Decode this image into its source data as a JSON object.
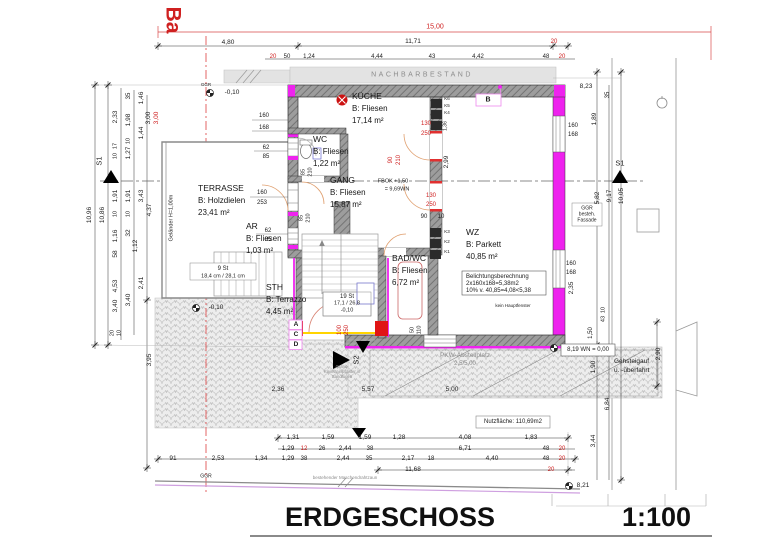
{
  "meta": {
    "title": "ERDGESCHOSS",
    "scale": "1:100"
  },
  "rooms": [
    {
      "name": "KÜCHE",
      "finish": "B: Fliesen",
      "area": "17,14 m²",
      "x": 352,
      "y": 90
    },
    {
      "name": "WC",
      "finish": "B: Fliesen",
      "area": "1,22 m²",
      "x": 313,
      "y": 133
    },
    {
      "name": "GANG",
      "finish": "B: Fliesen",
      "area": "15,87 m²",
      "x": 330,
      "y": 174
    },
    {
      "name": "TERRASSE",
      "finish": "B: Holzdielen",
      "area": "23,41 m²",
      "x": 198,
      "y": 182
    },
    {
      "name": "AR",
      "finish": "B: Fliesen",
      "area": "1,03 m²",
      "x": 246,
      "y": 220
    },
    {
      "name": "WZ",
      "finish": "B: Parkett",
      "area": "40,85 m²",
      "x": 466,
      "y": 226
    },
    {
      "name": "BAD/WC",
      "finish": "B: Fliesen",
      "area": "6,72 m²",
      "x": 392,
      "y": 252
    },
    {
      "name": "STH",
      "finish": "B: Terrazzo",
      "area": "4,45 m²",
      "x": 266,
      "y": 281
    }
  ],
  "labels": [
    {
      "t": "Ba",
      "x": 173,
      "y": 20,
      "r": 2,
      "s": 21,
      "b": 1,
      "c": "r",
      "n": "bau-line-label"
    },
    {
      "t": "15,00",
      "x": 435,
      "y": 27,
      "c": "r",
      "s": 7
    },
    {
      "t": "4,80",
      "x": 228,
      "y": 43
    },
    {
      "t": "11,71",
      "x": 413,
      "y": 42
    },
    {
      "t": "20",
      "x": 554,
      "y": 42,
      "c": "r",
      "s": 6
    },
    {
      "t": "20",
      "x": 273,
      "y": 57,
      "c": "r",
      "s": 6
    },
    {
      "t": "50",
      "x": 287,
      "y": 57,
      "s": 6
    },
    {
      "t": "1,24",
      "x": 309,
      "y": 57,
      "s": 6
    },
    {
      "t": "4,44",
      "x": 377,
      "y": 57,
      "s": 6
    },
    {
      "t": "43",
      "x": 432,
      "y": 57,
      "s": 6
    },
    {
      "t": "4,42",
      "x": 478,
      "y": 57,
      "s": 6
    },
    {
      "t": "48",
      "x": 546,
      "y": 57,
      "s": 6
    },
    {
      "t": "20",
      "x": 562,
      "y": 57,
      "c": "r",
      "s": 6
    },
    {
      "t": "NACHBARBESTAND",
      "x": 422,
      "y": 75,
      "c": "g",
      "k": 1,
      "s": 7,
      "n": "neighbor-building-label"
    },
    {
      "t": "8,23",
      "x": 586,
      "y": 87
    },
    {
      "t": "GGR",
      "x": 206,
      "y": 85,
      "s": 4.5,
      "n": "ggr-label"
    },
    {
      "t": "-0,10",
      "x": 232,
      "y": 93,
      "s": 6.5,
      "n": "level-label"
    },
    {
      "t": "10,96",
      "x": 90,
      "y": 215,
      "r": 1
    },
    {
      "t": "10,86",
      "x": 103,
      "y": 215,
      "r": 1
    },
    {
      "t": "2,33",
      "x": 116,
      "y": 117,
      "r": 1
    },
    {
      "t": "17",
      "x": 116,
      "y": 146,
      "r": 1,
      "s": 5.5
    },
    {
      "t": "10",
      "x": 116,
      "y": 156,
      "r": 1,
      "s": 5.5
    },
    {
      "t": "1,91",
      "x": 116,
      "y": 196,
      "r": 1
    },
    {
      "t": "10",
      "x": 116,
      "y": 214,
      "r": 1,
      "s": 5.5
    },
    {
      "t": "1,16",
      "x": 116,
      "y": 236,
      "r": 1
    },
    {
      "t": "58",
      "x": 116,
      "y": 254,
      "r": 1
    },
    {
      "t": "4,53",
      "x": 116,
      "y": 286,
      "r": 1
    },
    {
      "t": "3,40",
      "x": 116,
      "y": 306,
      "r": 1
    },
    {
      "t": "20",
      "x": 113,
      "y": 333,
      "r": 1,
      "s": 5.5
    },
    {
      "t": "10",
      "x": 120,
      "y": 333,
      "r": 1,
      "s": 5.5
    },
    {
      "t": "35",
      "x": 129,
      "y": 96,
      "r": 1,
      "s": 6
    },
    {
      "t": "1,98",
      "x": 129,
      "y": 120,
      "r": 1
    },
    {
      "t": "10",
      "x": 129,
      "y": 141,
      "r": 1,
      "s": 5.5
    },
    {
      "t": "1,27",
      "x": 129,
      "y": 153,
      "r": 1
    },
    {
      "t": "1,91",
      "x": 129,
      "y": 196,
      "r": 1
    },
    {
      "t": "10",
      "x": 129,
      "y": 214,
      "r": 1,
      "s": 5.5
    },
    {
      "t": "32",
      "x": 129,
      "y": 233,
      "r": 1
    },
    {
      "t": "3,40",
      "x": 129,
      "y": 300,
      "r": 1
    },
    {
      "t": "1,46",
      "x": 142,
      "y": 98,
      "r": 1
    },
    {
      "t": "1,44",
      "x": 142,
      "y": 133,
      "r": 1
    },
    {
      "t": "3,43",
      "x": 142,
      "y": 196,
      "r": 1
    },
    {
      "t": "1,12",
      "x": 136,
      "y": 246,
      "r": 1
    },
    {
      "t": "2,41",
      "x": 142,
      "y": 283,
      "r": 1
    },
    {
      "t": "3,00",
      "x": 149,
      "y": 118,
      "r": 1
    },
    {
      "t": "3,00",
      "x": 157,
      "y": 118,
      "r": 1,
      "c": "r"
    },
    {
      "t": "4,37",
      "x": 150,
      "y": 210,
      "r": 1
    },
    {
      "t": "3,95",
      "x": 150,
      "y": 360,
      "r": 1
    },
    {
      "t": "S1",
      "x": 99,
      "y": 161,
      "r": 1,
      "s": 7.5,
      "n": "section-marker-label"
    },
    {
      "t": "160",
      "x": 264,
      "y": 116,
      "s": 6
    },
    {
      "t": "168",
      "x": 264,
      "y": 128,
      "s": 6
    },
    {
      "t": "62",
      "x": 266,
      "y": 148,
      "s": 6
    },
    {
      "t": "85",
      "x": 266,
      "y": 157,
      "s": 6
    },
    {
      "t": "160",
      "x": 262,
      "y": 193,
      "s": 6
    },
    {
      "t": "253",
      "x": 262,
      "y": 203,
      "s": 6
    },
    {
      "t": "62",
      "x": 268,
      "y": 231,
      "s": 6
    },
    {
      "t": "85",
      "x": 268,
      "y": 240,
      "s": 6
    },
    {
      "t": "85",
      "x": 304,
      "y": 172,
      "r": 1,
      "s": 5.5
    },
    {
      "t": "210",
      "x": 311,
      "y": 172,
      "r": 1,
      "s": 5.5
    },
    {
      "t": "85",
      "x": 302,
      "y": 218,
      "r": 1,
      "s": 5.5
    },
    {
      "t": "210",
      "x": 309,
      "y": 218,
      "r": 1,
      "s": 5.5
    },
    {
      "t": "Geländer H=1,00m",
      "x": 172,
      "y": 218,
      "r": 1,
      "s": 5.5,
      "n": "railing-label"
    },
    {
      "t": "9 St",
      "x": 223,
      "y": 269,
      "s": 6,
      "n": "stair-count-label"
    },
    {
      "t": "18,4 cm / 28,1 cm",
      "x": 223,
      "y": 277,
      "s": 5.5
    },
    {
      "t": "-0,10",
      "x": 216,
      "y": 308,
      "s": 6.5,
      "n": "level-label"
    },
    {
      "t": "19 St",
      "x": 347,
      "y": 297,
      "s": 6,
      "n": "stair-count-label"
    },
    {
      "t": "17,1 / 26,8",
      "x": 347,
      "y": 304,
      "s": 5.5
    },
    {
      "t": "-0,10",
      "x": 347,
      "y": 311,
      "s": 5.5
    },
    {
      "t": "FBOK +1,50",
      "x": 393,
      "y": 182,
      "s": 5.5,
      "n": "floor-level-label"
    },
    {
      "t": "= 9,69WN",
      "x": 397,
      "y": 190,
      "s": 5.5
    },
    {
      "t": "130",
      "x": 426,
      "y": 124,
      "c": "r",
      "s": 6
    },
    {
      "t": "250",
      "x": 426,
      "y": 134,
      "c": "r",
      "s": 6
    },
    {
      "t": "130",
      "x": 431,
      "y": 196,
      "c": "r",
      "s": 6
    },
    {
      "t": "250",
      "x": 431,
      "y": 205,
      "c": "r",
      "s": 6
    },
    {
      "t": "90",
      "x": 391,
      "y": 160,
      "r": 1,
      "c": "r",
      "s": 6
    },
    {
      "t": "210",
      "x": 399,
      "y": 160,
      "r": 1,
      "c": "r",
      "s": 6
    },
    {
      "t": "100",
      "x": 340,
      "y": 330,
      "r": 1,
      "c": "r",
      "s": 6
    },
    {
      "t": "250",
      "x": 347,
      "y": 330,
      "r": 1,
      "c": "r",
      "s": 6
    },
    {
      "t": "90",
      "x": 424,
      "y": 217,
      "s": 6
    },
    {
      "t": "10",
      "x": 441,
      "y": 217,
      "s": 6
    },
    {
      "t": "2,99",
      "x": 447,
      "y": 162,
      "r": 1
    },
    {
      "t": "K6",
      "x": 447,
      "y": 99,
      "s": 4.5
    },
    {
      "t": "K5",
      "x": 447,
      "y": 106,
      "s": 4.5
    },
    {
      "t": "K4",
      "x": 447,
      "y": 113,
      "s": 4.5
    },
    {
      "t": "1,36",
      "x": 446,
      "y": 126,
      "r": 1,
      "s": 5
    },
    {
      "t": "K3",
      "x": 447,
      "y": 232,
      "s": 4.5
    },
    {
      "t": "K2",
      "x": 447,
      "y": 242,
      "s": 4.5
    },
    {
      "t": "K1",
      "x": 447,
      "y": 252,
      "s": 4.5
    },
    {
      "t": "50",
      "x": 413,
      "y": 330,
      "r": 1,
      "s": 5.5
    },
    {
      "t": "110",
      "x": 420,
      "y": 330,
      "r": 1,
      "s": 5.5
    },
    {
      "t": "B",
      "x": 488,
      "y": 100,
      "s": 7,
      "b": 1,
      "n": "marker-b-label"
    },
    {
      "t": "Belichtungsberechnung",
      "x": 466,
      "y": 277,
      "s": 6,
      "a": "l",
      "n": "lighting-calc-line"
    },
    {
      "t": "2x160x168=5,38m2",
      "x": 466,
      "y": 284,
      "s": 6,
      "a": "l"
    },
    {
      "t": "10% v. 40,85=4,08<5,38",
      "x": 466,
      "y": 291,
      "s": 6,
      "a": "l"
    },
    {
      "t": "kein Hauptfenster",
      "x": 513,
      "y": 306,
      "s": 4.5
    },
    {
      "t": "35",
      "x": 608,
      "y": 95,
      "r": 1,
      "s": 6
    },
    {
      "t": "1,89",
      "x": 595,
      "y": 119,
      "r": 1
    },
    {
      "t": "160",
      "x": 573,
      "y": 126,
      "s": 6
    },
    {
      "t": "168",
      "x": 573,
      "y": 135,
      "s": 6
    },
    {
      "t": "S1",
      "x": 620,
      "y": 163,
      "s": 7.5,
      "n": "section-marker-label"
    },
    {
      "t": "5,82",
      "x": 598,
      "y": 198,
      "r": 1
    },
    {
      "t": "9,17",
      "x": 610,
      "y": 196,
      "r": 1
    },
    {
      "t": "10,05",
      "x": 622,
      "y": 196,
      "r": 1
    },
    {
      "t": "GGR",
      "x": 587,
      "y": 209,
      "s": 5
    },
    {
      "t": "besteh.",
      "x": 587,
      "y": 215,
      "s": 5
    },
    {
      "t": "Fassade",
      "x": 587,
      "y": 221,
      "s": 5
    },
    {
      "t": "160",
      "x": 571,
      "y": 264,
      "s": 6
    },
    {
      "t": "168",
      "x": 571,
      "y": 273,
      "s": 6
    },
    {
      "t": "2,35",
      "x": 572,
      "y": 288,
      "r": 1
    },
    {
      "t": "10",
      "x": 604,
      "y": 310,
      "r": 1,
      "s": 5.5
    },
    {
      "t": "43",
      "x": 604,
      "y": 319,
      "r": 1,
      "s": 5.5
    },
    {
      "t": "1,50",
      "x": 591,
      "y": 333,
      "r": 1,
      "s": 6
    },
    {
      "t": "8,19 WN = 0,00",
      "x": 588,
      "y": 350,
      "s": 6,
      "n": "datum-level-label"
    },
    {
      "t": "1,90",
      "x": 594,
      "y": 367,
      "r": 1
    },
    {
      "t": "Gehsteigauf",
      "x": 614,
      "y": 362,
      "s": 6.5,
      "a": "l",
      "n": "sidewalk-label"
    },
    {
      "t": "u. -überfahrt",
      "x": 614,
      "y": 371,
      "s": 6.5,
      "a": "l"
    },
    {
      "t": "2,90",
      "x": 659,
      "y": 354,
      "r": 1
    },
    {
      "t": "6,84",
      "x": 608,
      "y": 404,
      "r": 1
    },
    {
      "t": "3,44",
      "x": 594,
      "y": 441,
      "r": 1
    },
    {
      "t": "A",
      "x": 296,
      "y": 325,
      "s": 6.5,
      "b": 1,
      "n": "marker-a-label"
    },
    {
      "t": "C",
      "x": 296,
      "y": 335,
      "s": 6.5,
      "b": 1,
      "n": "marker-c-label"
    },
    {
      "t": "D",
      "x": 296,
      "y": 345,
      "s": 6.5,
      "b": 1,
      "n": "marker-d-label"
    },
    {
      "t": "S2",
      "x": 356,
      "y": 360,
      "r": 1,
      "s": 7.5,
      "n": "section-marker-label"
    },
    {
      "t": "Granit-",
      "x": 342,
      "y": 367,
      "s": 4.2,
      "c": "g"
    },
    {
      "t": "Kleinsteinpflaster in",
      "x": 342,
      "y": 372,
      "s": 4.2,
      "c": "g"
    },
    {
      "t": "Sandfugen",
      "x": 342,
      "y": 377,
      "s": 4.2,
      "c": "g"
    },
    {
      "t": "PKW-Abstellplatz",
      "x": 465,
      "y": 356,
      "s": 6.5,
      "c": "g",
      "n": "parking-label"
    },
    {
      "t": "2,5/5,00",
      "x": 465,
      "y": 364,
      "s": 6,
      "c": "g"
    },
    {
      "t": "2,36",
      "x": 278,
      "y": 390,
      "s": 6.5
    },
    {
      "t": "5,57",
      "x": 368,
      "y": 390,
      "s": 6.5
    },
    {
      "t": "5,00",
      "x": 452,
      "y": 390,
      "s": 6.5
    },
    {
      "t": "Nutzfläche: 110,69m2",
      "x": 513,
      "y": 422,
      "s": 6,
      "n": "usable-area-label"
    },
    {
      "t": "1,31",
      "x": 293,
      "y": 438
    },
    {
      "t": "1,59",
      "x": 328,
      "y": 438
    },
    {
      "t": "1,59",
      "x": 365,
      "y": 438
    },
    {
      "t": "1,28",
      "x": 399,
      "y": 438
    },
    {
      "t": "4,08",
      "x": 465,
      "y": 438
    },
    {
      "t": "1,83",
      "x": 531,
      "y": 438
    },
    {
      "t": "1,29",
      "x": 288,
      "y": 449
    },
    {
      "t": "12",
      "x": 304,
      "y": 449,
      "c": "r",
      "s": 6
    },
    {
      "t": "26",
      "x": 322,
      "y": 449,
      "s": 6
    },
    {
      "t": "2,44",
      "x": 345,
      "y": 449
    },
    {
      "t": "38",
      "x": 370,
      "y": 449,
      "s": 6
    },
    {
      "t": "6,71",
      "x": 465,
      "y": 449
    },
    {
      "t": "48",
      "x": 546,
      "y": 449,
      "s": 6
    },
    {
      "t": "20",
      "x": 562,
      "y": 449,
      "c": "r",
      "s": 6
    },
    {
      "t": "91",
      "x": 173,
      "y": 459
    },
    {
      "t": "2,53",
      "x": 218,
      "y": 459
    },
    {
      "t": "1,34",
      "x": 261,
      "y": 459
    },
    {
      "t": "1,29",
      "x": 288,
      "y": 459
    },
    {
      "t": "38",
      "x": 304,
      "y": 459,
      "s": 6
    },
    {
      "t": "2,44",
      "x": 343,
      "y": 459
    },
    {
      "t": "35",
      "x": 369,
      "y": 459,
      "s": 6
    },
    {
      "t": "2,17",
      "x": 408,
      "y": 459
    },
    {
      "t": "18",
      "x": 431,
      "y": 459,
      "s": 6
    },
    {
      "t": "4,40",
      "x": 492,
      "y": 459
    },
    {
      "t": "48",
      "x": 546,
      "y": 459,
      "s": 6
    },
    {
      "t": "20",
      "x": 562,
      "y": 459,
      "c": "r",
      "s": 6
    },
    {
      "t": "11,68",
      "x": 413,
      "y": 470
    },
    {
      "t": "20",
      "x": 551,
      "y": 470,
      "c": "r",
      "s": 6
    },
    {
      "t": "8,21",
      "x": 583,
      "y": 486,
      "s": 6.5
    },
    {
      "t": "GGR",
      "x": 206,
      "y": 477,
      "s": 5,
      "n": "ggr-label"
    },
    {
      "t": "bestehender Maschendrahtzaun",
      "x": 345,
      "y": 478,
      "s": 4.5,
      "c": "g",
      "n": "fence-label"
    }
  ]
}
